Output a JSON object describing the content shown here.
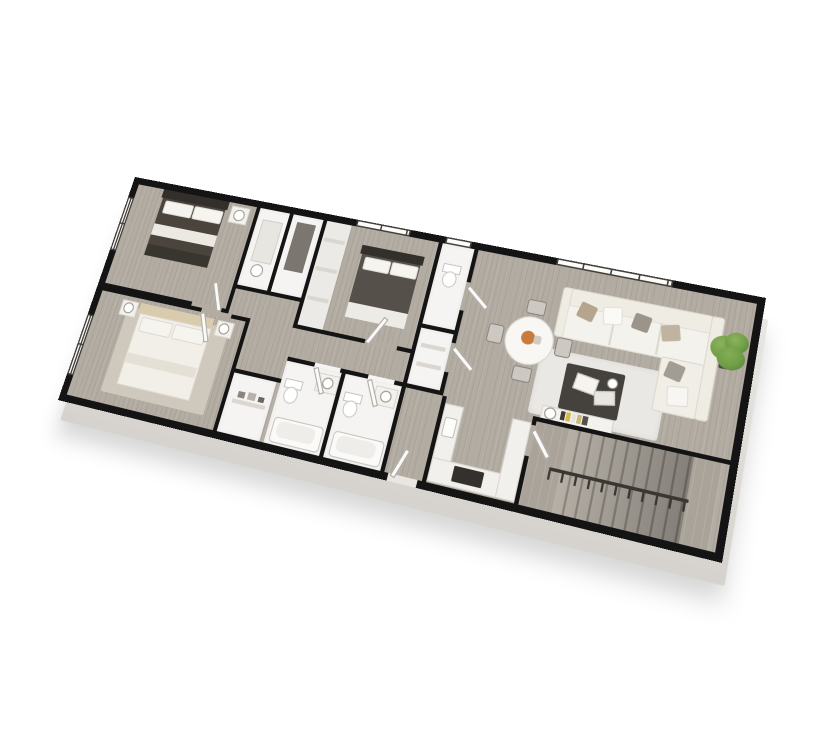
{
  "scene": {
    "type": "3d-rendered floor plan, isometric rotated view on white background",
    "background": "#ffffff",
    "outline": "#141414"
  },
  "colors": {
    "wall": "#141414",
    "wood": "#b3aca2",
    "wood-dark": "#a0998f",
    "tile": "#f5f4f2",
    "slab": "#e9e7e3",
    "slab-edge": "#d6d3ce",
    "white-f": "#f3f1ec",
    "cream": "#efece4",
    "bed-dark": "#4a443d",
    "headboard-dark": "#332f2b",
    "headboard-tan": "#d8cbae",
    "pillow": "#f6f4ef",
    "pillow-tan": "#b5a48e",
    "pillow-gray": "#9b948b",
    "table-dark": "#45423e",
    "rug": "#eae8e4",
    "rug-warm": "#cfc9bd",
    "plant": "#6f9e45",
    "plant-dark": "#527c33",
    "accent": "#c97a3d",
    "book-yellow": "#d9b84a",
    "frame": "#44413c"
  },
  "rooms": [
    {
      "id": "bedroom-1",
      "label": "Bedroom",
      "furniture": [
        "double bed with dark duvet and white pillows",
        "nightstand with round lamp",
        "left-wall window"
      ]
    },
    {
      "id": "closets",
      "label": "Closets",
      "furniture": [
        "storage shelf",
        "clothes rail",
        "basket"
      ]
    },
    {
      "id": "bedroom-3",
      "label": "Bedroom",
      "furniture": [
        "double bed with dark duvet",
        "closet shelving",
        "top-wall window"
      ]
    },
    {
      "id": "primary-bedroom",
      "label": "Primary Bedroom",
      "furniture": [
        "double bed with white duvet and tan headboard",
        "two nightstands with lamps",
        "area rug",
        "left-wall window"
      ]
    },
    {
      "id": "laundry-closet",
      "label": "Closet",
      "furniture": [
        "shelf with linens"
      ]
    },
    {
      "id": "bathroom-1",
      "label": "Bath",
      "furniture": [
        "bathtub",
        "toilet",
        "vanity"
      ]
    },
    {
      "id": "bathroom-2",
      "label": "Bath",
      "furniture": [
        "bathtub",
        "toilet",
        "vanity"
      ]
    },
    {
      "id": "half-bath",
      "label": "Half Bath",
      "furniture": [
        "toilet",
        "small top-wall window"
      ]
    },
    {
      "id": "linen-closet",
      "label": "Linen Closet",
      "furniture": [
        "shelves"
      ]
    },
    {
      "id": "hallway",
      "label": "Hall",
      "furniture": []
    },
    {
      "id": "entry",
      "label": "Entry",
      "furniture": [
        "entry door in bottom wall"
      ]
    },
    {
      "id": "kitchen",
      "label": "Kitchen",
      "furniture": [
        "U-shaped counter",
        "dark cooktop",
        "sink"
      ]
    },
    {
      "id": "living-dining",
      "label": "Living / Dining",
      "furniture": [
        "L-shaped cream sectional sofa",
        "tan, gray and white throw pillows",
        "dark coffee table with books",
        "light area rug",
        "round white dining table with orange centerpiece",
        "four dining chairs",
        "potted green plant in corner",
        "console shelf with books and lamp",
        "long top-wall window"
      ]
    },
    {
      "id": "stairs",
      "label": "Stairs",
      "furniture": [
        "straight staircase",
        "handrail with balusters"
      ]
    }
  ]
}
